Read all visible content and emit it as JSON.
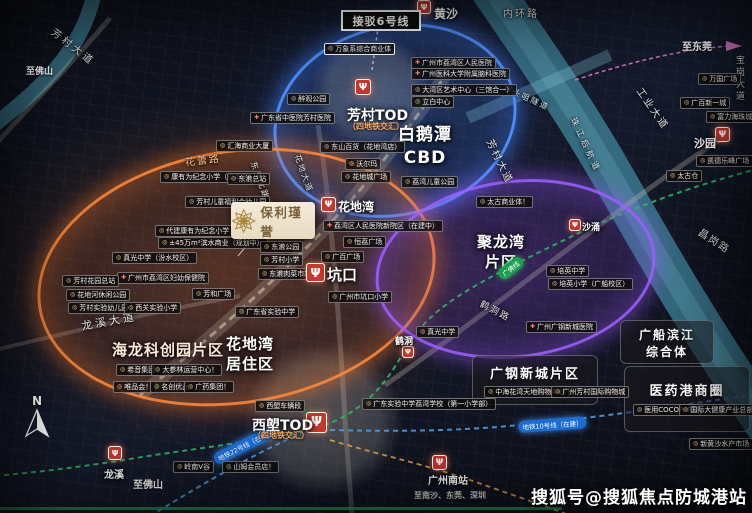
{
  "meta": {
    "watermark": "搜狐号@搜狐焦点防城港站",
    "compass": "N"
  },
  "project": {
    "name": "保利瑾誉"
  },
  "colors": {
    "orange": "#ff8a3c",
    "blue": "#4f8dff",
    "purple": "#9b5cff",
    "metro_red": "#c43a2e",
    "gold": "#ab8d55",
    "river": "#3d7d93"
  },
  "icons": {
    "metro": "Ψ",
    "poi": "◎",
    "hospital": "✚"
  },
  "lines": {
    "line6": "接驳6号线",
    "line10": "地铁10号线（在建）",
    "line22": "地铁22号线（在建）",
    "gf": "广佛线"
  },
  "zones": {
    "baietan1": "白鹅潭",
    "baietan2": "CBD",
    "julong1": "聚龙湾",
    "julong2": "片区",
    "hailong": "海龙科创园片区",
    "huadi1": "花地湾",
    "huadi2": "居住区",
    "guanggang": "广钢新城片区",
    "guangchuan1": "广船滨江",
    "guangchuan2": "综合体",
    "yiyaogang": "医药港商圈"
  },
  "stations": {
    "huangsha": "黄沙",
    "fangcun_tod": "芳村TOD",
    "fangcun_sub": "（四地铁交汇）",
    "huadiwan": "花地湾",
    "kengkou": "坑口",
    "hedong": "鹤洞",
    "shayong": "沙涌",
    "shayuan": "沙园",
    "longxi": "龙溪",
    "xilang_tod": "西塱TOD",
    "xilang_sub": "（四地铁交汇）",
    "gznan": "广州南站"
  },
  "roads": {
    "neihuan": "内环路",
    "fangcun_dd1": "芳村大道",
    "fangcun_dd2": "芳村大道",
    "hualei": "花蕾路",
    "dongjiao_bl": "东漖北路",
    "huadi_dd": "花地大道",
    "longxi_dd": "龙溪大道",
    "gongye_dd": "工业大道",
    "baogang_dd": "宝岗大道",
    "changgang": "昌岗路",
    "hedong_rd": "鹤洞路",
    "zhoutouju": "洲头咀隧道",
    "zhujiang": "珠江后航道"
  },
  "dirs": {
    "dongguan": "至东莞",
    "foshan_tl": "至佛山",
    "foshan_bl": "至佛山",
    "nansha": "至南沙、东莞、深圳"
  },
  "pois": {
    "wanxiang": "万象系综合商业体",
    "renmin_hosp": "广州市荔湾区人民医院",
    "naoke_hosp": "广州医科大学附属脑科医院",
    "dawanqu_art": "大湾区艺术中心（三馆合一）",
    "libai": "立白中心",
    "zuiguan": "醉观公园",
    "shengzhongyi": "广东省中医院芳村医院",
    "huihai": "汇海商业大厦",
    "kangyouwei": "康有为纪念小学（校本部）",
    "dongjiao_zz": "东漖总站",
    "ertong_fuli": "芳村儿童福利会幼儿园",
    "daijian_kyw": "代建康有为纪念小学（在建中）",
    "binshui": "±45万m²滨水商业（规划中）",
    "zhenguang_fs": "真光中学（汾水校区）",
    "fuyou": "广州市荔湾区妇幼保健院",
    "fc_huayuan_zz": "芳村花园总站",
    "huadihe_park": "花地河休闲公园",
    "fc_yey": "芳村实验幼儿园",
    "xiguan_xx": "西关实验小学",
    "fanghe": "芳和广场",
    "shengshi": "广东省实验中学",
    "dongjiao_park": "东漖公园",
    "fangcun_xx": "芳村小学",
    "dongjiao_sc": "东漖肉菜市场",
    "shein": "希音集团！",
    "dashenlin": "大参林运营中心！",
    "weipinhui": "唯品会！",
    "mingchuang": "名创优品！",
    "guangyao": "广药集团！",
    "lingnanv": "岭南V谷",
    "sams": "山姆会员店！",
    "xilang_depot": "西塱车辆段",
    "shengshi_lw": "广东实验中学荔湾学校（第一小学部）",
    "guangbai_gc": "广百广场",
    "kengkou_xx": "广州市坑口小学",
    "zhenguang": "真光中学",
    "lw_children": "荔湾儿童公园",
    "dongshan": "东山百货（花地湾店）",
    "walmart": "沃尔玛",
    "huadicheng": "花地城广场",
    "renmin_new": "荔湾区人民医院新院区（在建中）",
    "hengli": "恒荔广场",
    "taigu_sy": "太古商业体！",
    "peiying_zx": "培英中学",
    "peiying_xx": "培英小学（广船校区）",
    "gg_hosp": "广州广钢新城医院",
    "zhonghai": "中海花湾天地购物中心",
    "fc_intl": "广州芳村国际购物城",
    "cocopark": "医用COCOPARK",
    "dajiankang": "国际大健康产业总部！",
    "xhs_market": "新黄沙水产市场",
    "wanguo": "万国广场",
    "gb_xyc": "广百新一城",
    "fuli": "富力海珠城",
    "kaide": "凯德乐峰广场",
    "taigucang": "太古仓"
  }
}
